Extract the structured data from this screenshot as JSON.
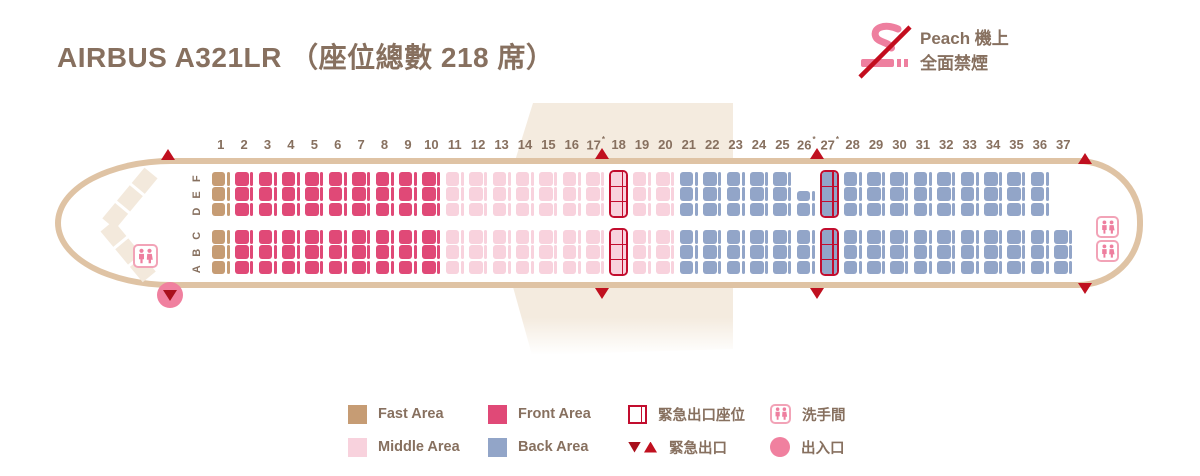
{
  "title": "AIRBUS A321LR （座位總數 218 席）",
  "no_smoking_notice": {
    "line1": "Peach 機上",
    "line2": "全面禁煙"
  },
  "colors": {
    "text_brown": "#87705f",
    "fuselage_outline": "#dfc3a4",
    "wing_fill": "#f4ebdf",
    "chevron_fill": "#f3e9dc",
    "fast": "#c69c74",
    "front": "#e04977",
    "middle": "#f8d2dd",
    "back": "#92a5c8",
    "exit_red": "#c20d2e",
    "triangle_red": "#c0101f",
    "pink_icon": "#ee7f9f",
    "pink_icon_border": "#f2a3b7",
    "door_pink": "#f0809f"
  },
  "cabin": {
    "row_numbers": [
      "1",
      "2",
      "3",
      "4",
      "5",
      "6",
      "7",
      "8",
      "9",
      "10",
      "11",
      "12",
      "13",
      "14",
      "15",
      "16",
      "17*",
      "18",
      "19",
      "20",
      "21",
      "22",
      "23",
      "24",
      "25",
      "26*",
      "27*",
      "28",
      "29",
      "30",
      "31",
      "32",
      "33",
      "34",
      "35",
      "36",
      "37"
    ],
    "letters_top_label": "D E F",
    "letters_bottom_label": "A B C",
    "seat_letters_top_order": [
      "F",
      "E",
      "D"
    ],
    "seat_letters_bottom_order": [
      "C",
      "B",
      "A"
    ],
    "areas": [
      {
        "id": "fast",
        "label": "Fast Area",
        "color": "#c69c74",
        "rows": [
          1,
          1
        ]
      },
      {
        "id": "front",
        "label": "Front Area",
        "color": "#e04977",
        "rows": [
          2,
          10
        ]
      },
      {
        "id": "middle",
        "label": "Middle Area",
        "color": "#f8d2dd",
        "rows": [
          11,
          20
        ]
      },
      {
        "id": "back",
        "label": "Back Area",
        "color": "#92a5c8",
        "rows": [
          21,
          37
        ]
      }
    ],
    "exit_seat_rows": {
      "18": "middle",
      "27": "back"
    },
    "missing_seats": [
      "26F",
      "37F",
      "37E",
      "37D"
    ],
    "small_seats": [
      "26E"
    ],
    "lavatories": [
      "front-left",
      "rear-upper",
      "rear-lower"
    ],
    "entrance_door": "front-left",
    "emergency_exit_positions": [
      "nose-top",
      "nose-bottom",
      "row17-18-top",
      "row17-18-bottom",
      "row26-27-top",
      "row26-27-bottom",
      "tail-top",
      "tail-bottom"
    ]
  },
  "legend": {
    "items": [
      {
        "icon": "fast-area-swatch",
        "label": "Fast Area"
      },
      {
        "icon": "front-area-swatch",
        "label": "Front Area"
      },
      {
        "icon": "exit-seat-icon",
        "label": "緊急出口座位"
      },
      {
        "icon": "lavatory-icon",
        "label": "洗手間"
      },
      {
        "icon": "middle-area-swatch",
        "label": "Middle Area"
      },
      {
        "icon": "back-area-swatch",
        "label": "Back Area"
      },
      {
        "icon": "exit-triangles-icon",
        "label": "緊急出口"
      },
      {
        "icon": "door-icon",
        "label": "出入口"
      }
    ]
  }
}
